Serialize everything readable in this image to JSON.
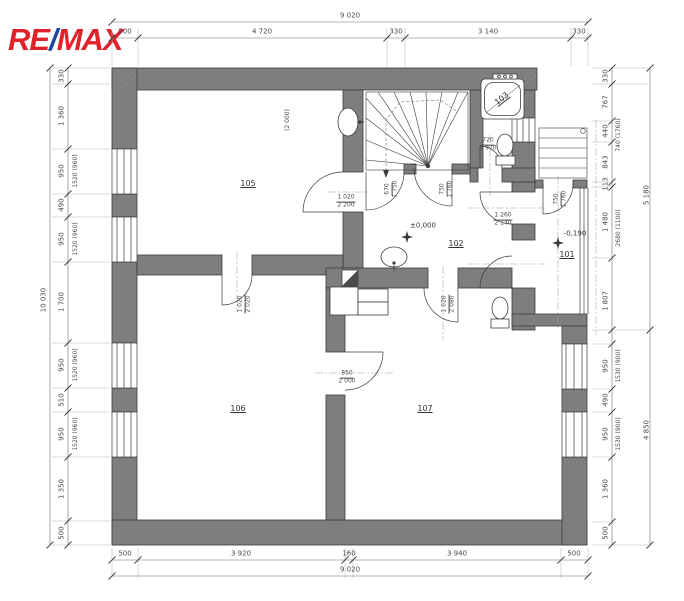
{
  "logo": {
    "re": "RE",
    "slash": "/",
    "max": "MAX"
  },
  "colors": {
    "logo_red": "#e0232a",
    "logo_blue": "#17469e",
    "wall_gray": "#7e7e7e",
    "line": "#3c3c3c"
  },
  "dims": {
    "top_total": "9 020",
    "top": [
      "500",
      "4 720",
      "330",
      "3 140",
      "330"
    ],
    "bottom": [
      "500",
      "3 920",
      "160",
      "3 940",
      "500"
    ],
    "bottom_total": "9 020",
    "left_total": "10 030",
    "left": [
      "330",
      "1 360",
      "950",
      "490",
      "950",
      "1 700",
      "950",
      "510",
      "950",
      "1 350",
      "500"
    ],
    "left_windows": [
      "1520 (960)",
      "1520 (960)",
      "1520 (960)",
      "1520 (960)"
    ],
    "right_upper": [
      "330",
      "767",
      "440",
      "843",
      "113",
      "1 480",
      "1 807"
    ],
    "right_upper_annotations": [
      "740 (1760)",
      "2680 (1100)"
    ],
    "right_lower": [
      "950",
      "490",
      "950",
      "1 360",
      "500"
    ],
    "right_lower_windows": [
      "1530 (900)",
      "1530 (900)"
    ],
    "right_totals": [
      "5 180",
      "4 850"
    ]
  },
  "rooms": {
    "entry": "101",
    "hall": "102",
    "bathroom": "103",
    "room_top_left": "105",
    "room_bottom_left": "106",
    "room_bottom_right": "107"
  },
  "levels": {
    "hall": "±0,000",
    "entry": "-0,190"
  },
  "doors": {
    "to_105": {
      "w": "1 020",
      "h": "2 200"
    },
    "stair": {
      "w": "670",
      "h": "1 750"
    },
    "hall_top": {
      "w": "750",
      "h": "1 760"
    },
    "entry_door": {
      "w": "750",
      "h": "1 760"
    },
    "to_entry": {
      "w": "1 260",
      "h": "2 140"
    },
    "wc": {
      "w": "720",
      "h": "1 970"
    },
    "to_107": {
      "w": "1 020",
      "h": "2 080"
    },
    "to_106": {
      "w": "1 020",
      "h": "2 020"
    },
    "between_106_107": {
      "w": "850",
      "h": "2 000"
    }
  },
  "annotations": {
    "niche": "(2 000)"
  }
}
